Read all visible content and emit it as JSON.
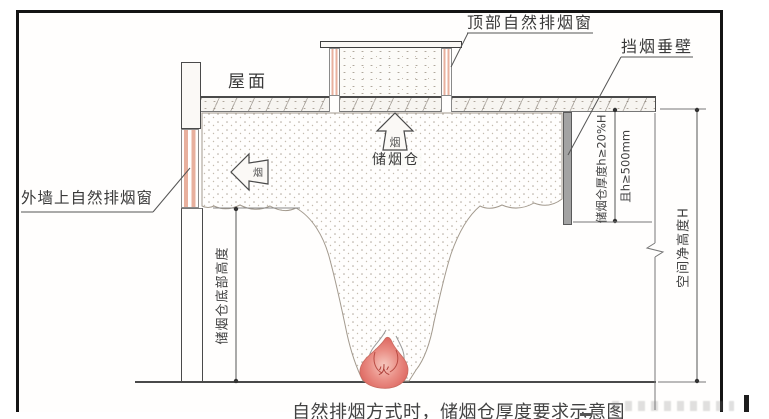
{
  "figure": {
    "caption": "自然排烟方式时，储烟仓厚度要求示意图",
    "labels": {
      "roof": "屋面",
      "top_natural_vent": "顶部自然排烟窗",
      "smoke_curtain": "挡烟垂壁",
      "wall_natural_vent": "外墙上自然排烟窗",
      "smoke_reservoir": "储烟仓",
      "smoke_flow_up": "烟",
      "smoke_flow_out": "烟",
      "fire": "火"
    },
    "dimensions": {
      "reservoir_bottom_height": "储烟仓底部高度",
      "reservoir_thickness": "储烟仓厚度h≥20%H",
      "reservoir_thickness_min": "且h≥500mm",
      "space_clear_height": "空间净高度H"
    },
    "colors": {
      "frame": "#141414",
      "linework": "#4a4a4a",
      "window_pink": "#e8b09e",
      "curtain_gray": "#a3a3a3",
      "flame_red": "#d95852",
      "stipple_tan": "#b0a89c",
      "background": "#ffffff"
    }
  }
}
